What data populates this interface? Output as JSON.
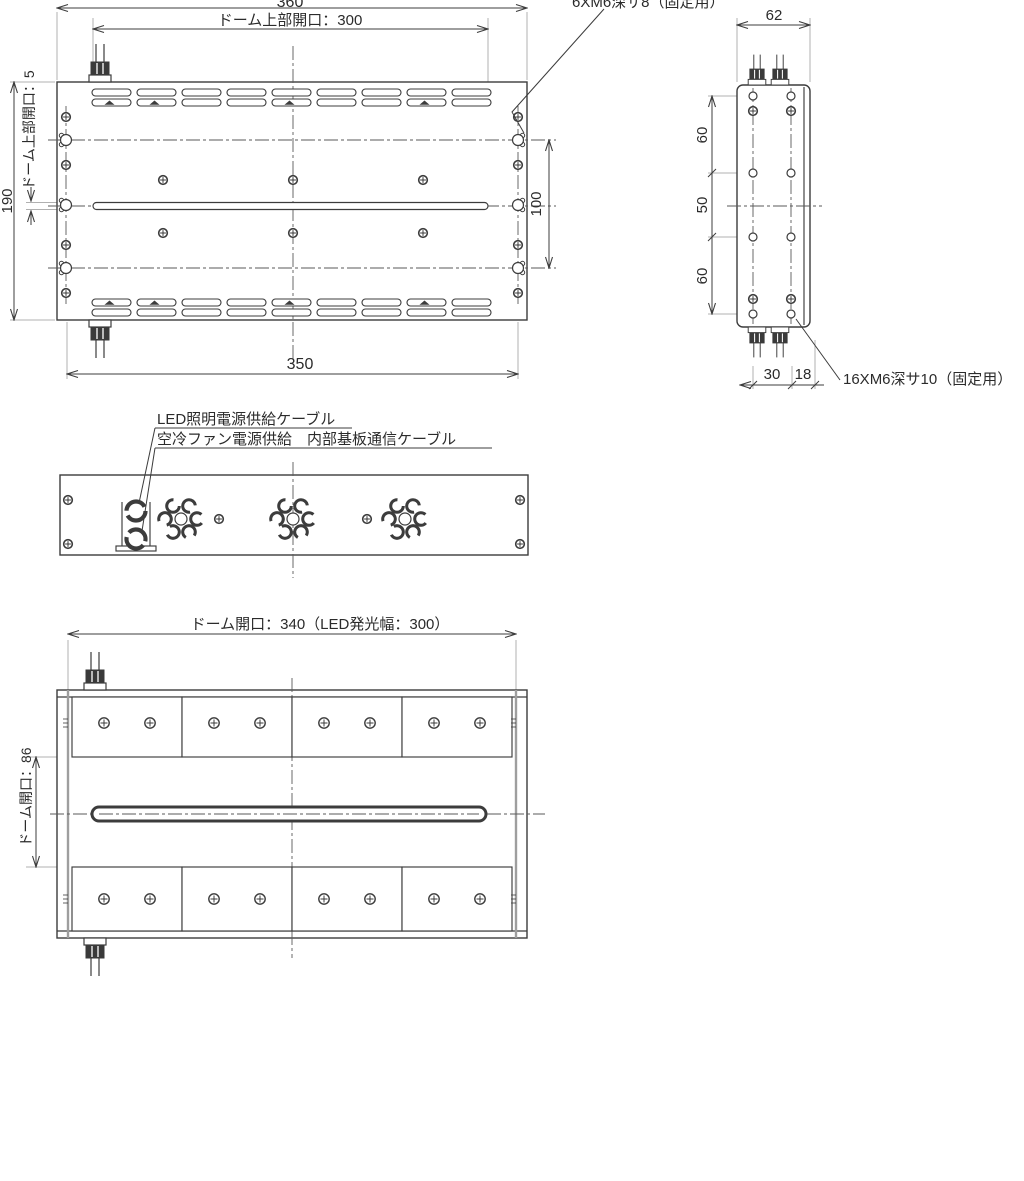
{
  "top_view": {
    "dim_360": "360",
    "dim_300": "ドーム上部開口：300",
    "dim_5": "ドーム上部開口：5",
    "dim_190": "190",
    "dim_100": "100",
    "dim_350": "350"
  },
  "side_view": {
    "dim_62": "62",
    "dim_60a": "60",
    "dim_50": "50",
    "dim_60b": "60",
    "dim_30": "30",
    "dim_18": "18"
  },
  "bottom_view": {
    "dim_340": "ドーム開口：340（LED発光幅：300）",
    "dim_86": "ドーム開口：86"
  },
  "annotations": {
    "fix6_label": "6XM6深サ8（固定用）",
    "fix16_label": "16XM6深サ10（固定用）",
    "cable1_label": "LED照明電源供給ケーブル",
    "cable2_label": "空冷ファン電源供給　内部基板通信ケーブル"
  },
  "colors": {
    "line": "#3c3c3c",
    "aux_line": "#b0b0b0",
    "text": "#2b2b2b"
  }
}
